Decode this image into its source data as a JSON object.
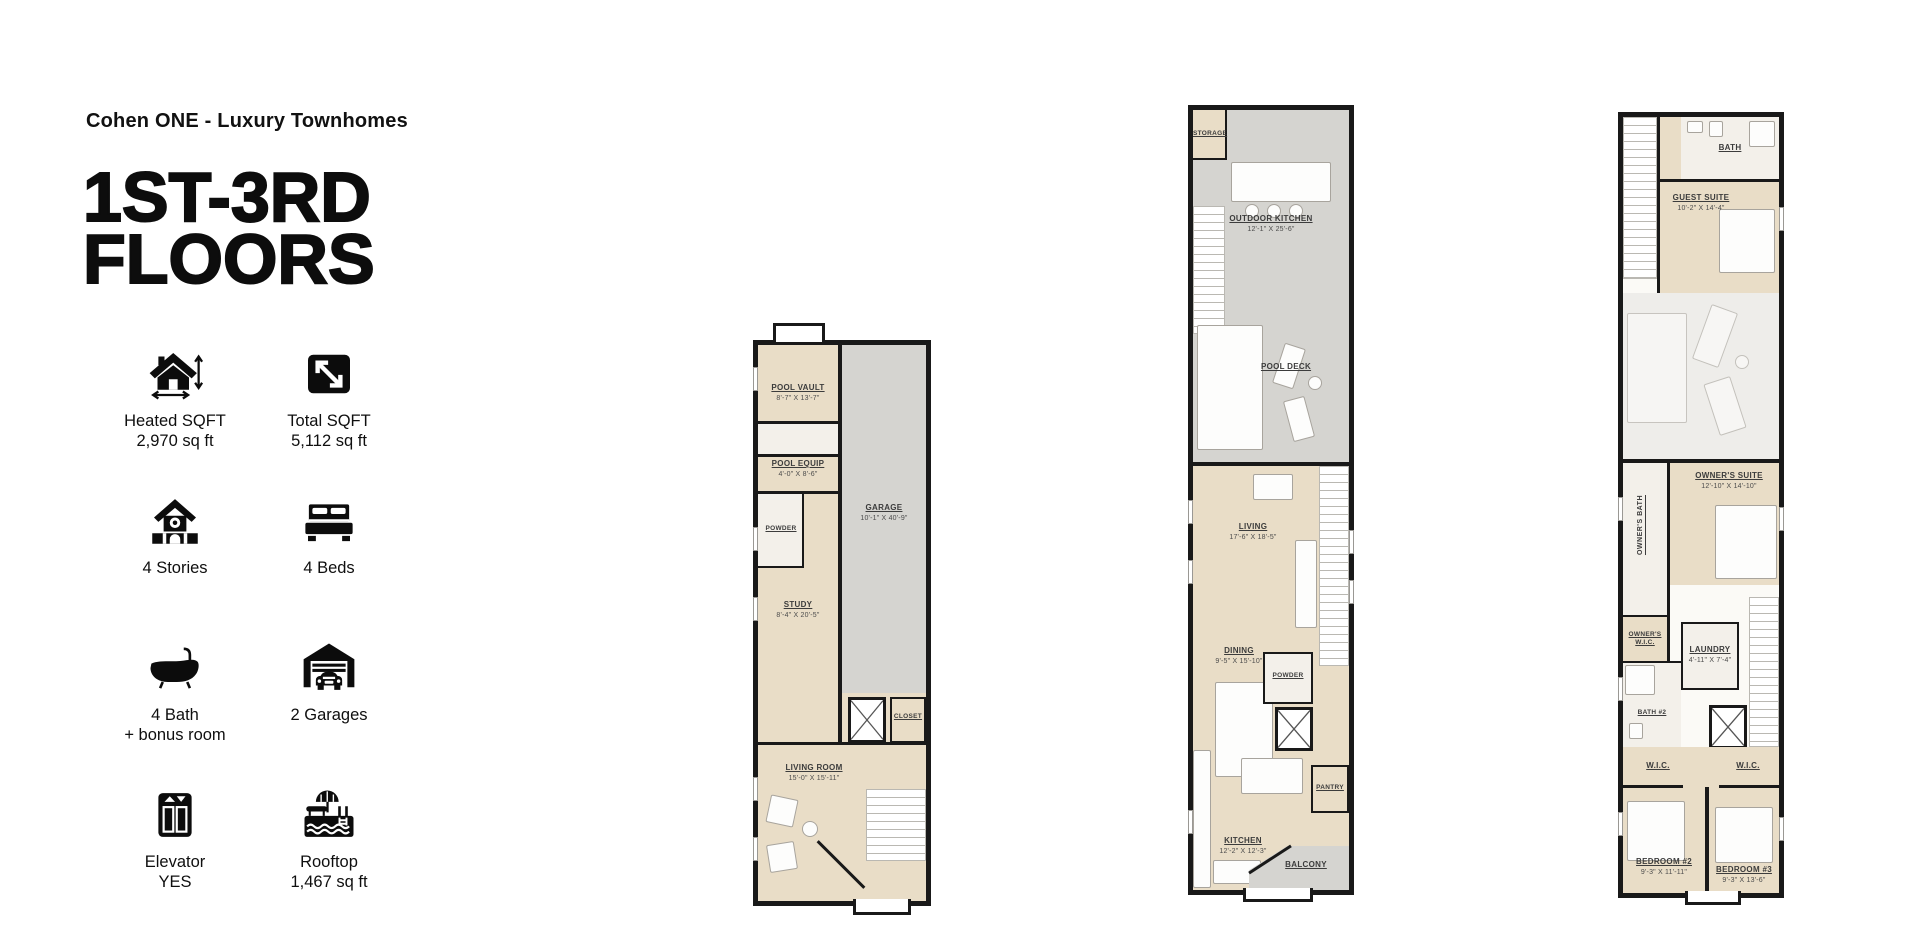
{
  "header": {
    "brand": "Cohen ONE - Luxury Townhomes",
    "title_line1": "1ST-3RD",
    "title_line2": "FLOORS"
  },
  "stats": {
    "heated": {
      "icon": "heated-sqft-icon",
      "label": "Heated SQFT",
      "value": "2,970 sq ft"
    },
    "total": {
      "icon": "total-sqft-icon",
      "label": "Total SQFT",
      "value": "5,112 sq ft"
    },
    "stories": {
      "icon": "stories-icon",
      "label": "4 Stories"
    },
    "beds": {
      "icon": "beds-icon",
      "label": "4 Beds"
    },
    "bath": {
      "icon": "bathtub-icon",
      "label": "4 Bath",
      "value": "+ bonus room"
    },
    "garages": {
      "icon": "garage-icon",
      "label": "2 Garages"
    },
    "elevator": {
      "icon": "elevator-icon",
      "label": "Elevator",
      "value": "YES"
    },
    "rooftop": {
      "icon": "rooftop-pool-icon",
      "label": "Rooftop",
      "value": "1,467 sq ft"
    }
  },
  "colors": {
    "beige": "#e9ddc7",
    "gray": "#d5d4d0",
    "wall": "#191919"
  },
  "floor1": {
    "pool_vault": {
      "label": "POOL VAULT",
      "dims": "8'-7\" X 13'-7\""
    },
    "pool_equip": {
      "label": "POOL EQUIP",
      "dims": "4'-0\" X 8'-6\""
    },
    "powder": {
      "label": "POWDER"
    },
    "garage": {
      "label": "GARAGE",
      "dims": "10'-1\" X 40'-9\""
    },
    "study": {
      "label": "STUDY",
      "dims": "8'-4\" X 20'-5\""
    },
    "closet": {
      "label": "CLOSET"
    },
    "living_room": {
      "label": "LIVING ROOM",
      "dims": "15'-0\" X 15'-11\""
    }
  },
  "floor2": {
    "storage": {
      "label": "STORAGE"
    },
    "outdoor_kitchen": {
      "label": "OUTDOOR KITCHEN",
      "dims": "12'-1\" X 25'-6\""
    },
    "pool_deck": {
      "label": "POOL DECK"
    },
    "living": {
      "label": "LIVING",
      "dims": "17'-6\" X 18'-5\""
    },
    "dining": {
      "label": "DINING",
      "dims": "9'-5\" X 15'-10\""
    },
    "powder": {
      "label": "POWDER"
    },
    "pantry": {
      "label": "PANTRY"
    },
    "kitchen": {
      "label": "KITCHEN",
      "dims": "12'-2\" X 12'-3\""
    },
    "balcony": {
      "label": "BALCONY"
    }
  },
  "floor3": {
    "bath": {
      "label": "BATH"
    },
    "guest_suite": {
      "label": "GUEST SUITE",
      "dims": "10'-2\" X 14'-4\""
    },
    "owners_suite": {
      "label": "OWNER'S SUITE",
      "dims": "12'-10\" X 14'-10\""
    },
    "owners_bath": {
      "label": "OWNER'S BATH"
    },
    "owners_wic": {
      "label": "OWNER'S W.I.C."
    },
    "laundry": {
      "label": "LAUNDRY",
      "dims": "4'-11\" X 7'-4\""
    },
    "bath2": {
      "label": "BATH #2"
    },
    "wic_left": {
      "label": "W.I.C."
    },
    "wic_right": {
      "label": "W.I.C."
    },
    "bedroom2": {
      "label": "BEDROOM #2",
      "dims": "9'-3\" X 11'-11\""
    },
    "bedroom3": {
      "label": "BEDROOM #3",
      "dims": "9'-3\" X 13'-6\""
    }
  }
}
